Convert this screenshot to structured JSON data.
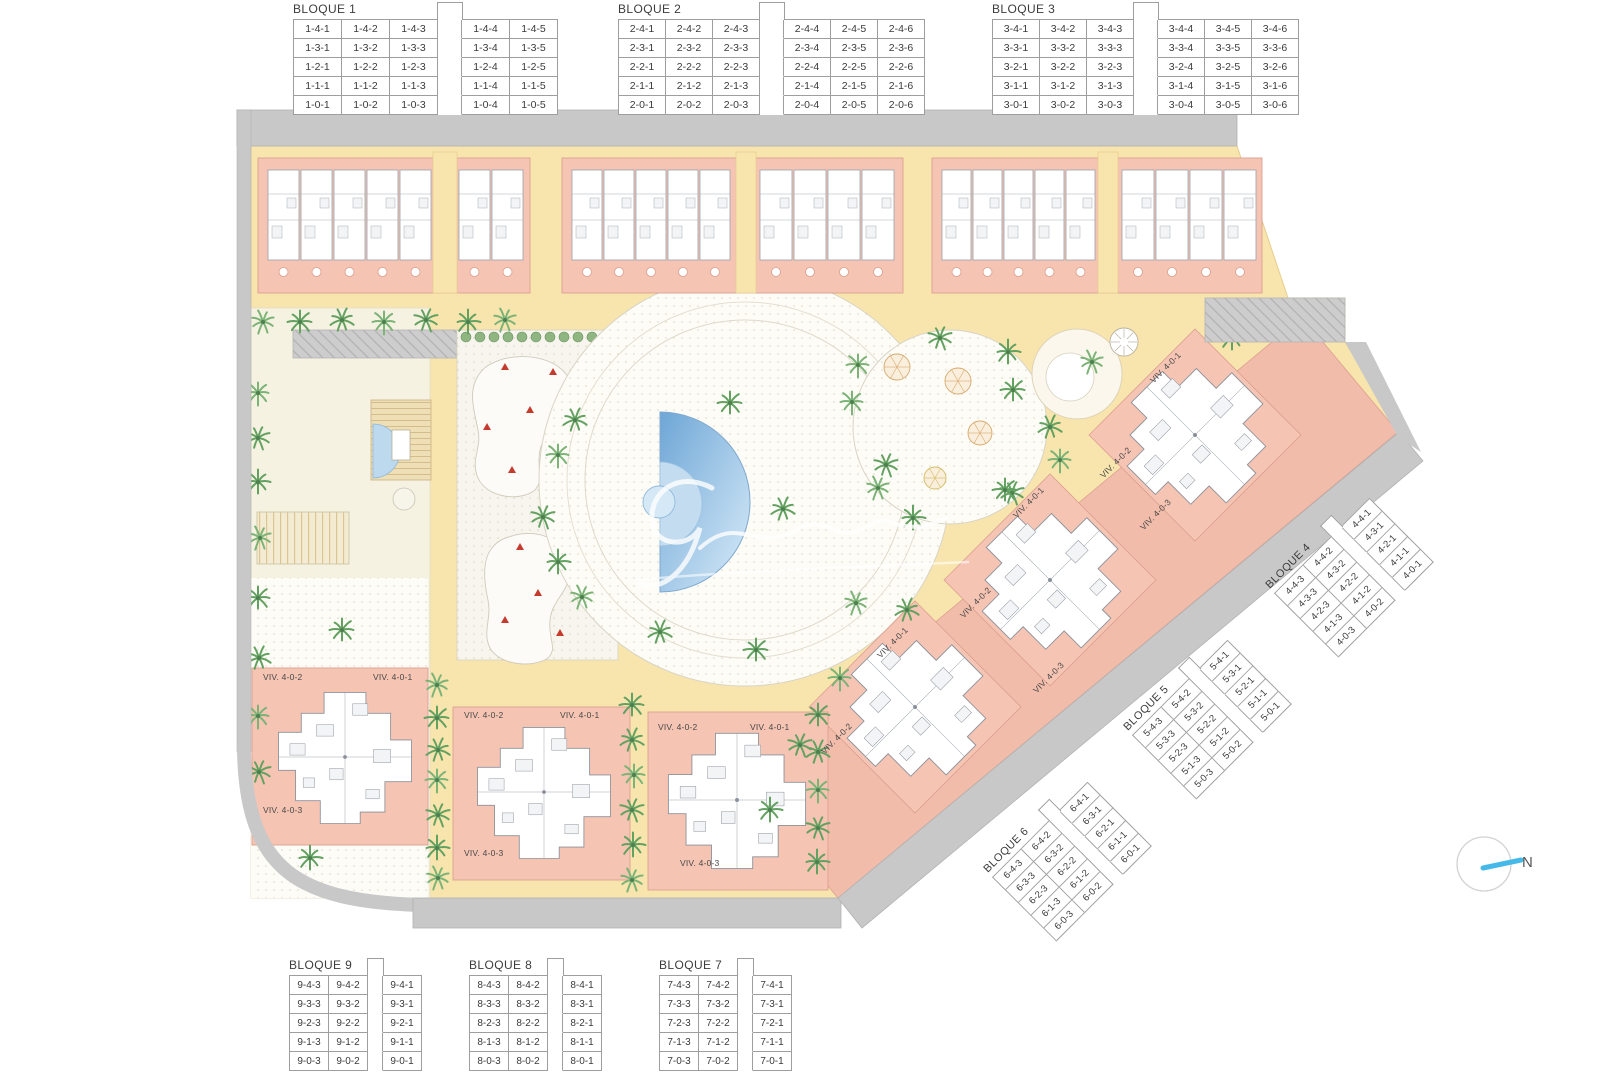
{
  "blocks_top": [
    {
      "title": "BLOQUE 1",
      "split_after": 3,
      "rows": [
        [
          "1-4-1",
          "1-4-2",
          "1-4-3",
          "1-4-4",
          "1-4-5"
        ],
        [
          "1-3-1",
          "1-3-2",
          "1-3-3",
          "1-3-4",
          "1-3-5"
        ],
        [
          "1-2-1",
          "1-2-2",
          "1-2-3",
          "1-2-4",
          "1-2-5"
        ],
        [
          "1-1-1",
          "1-1-2",
          "1-1-3",
          "1-1-4",
          "1-1-5"
        ],
        [
          "1-0-1",
          "1-0-2",
          "1-0-3",
          "1-0-4",
          "1-0-5"
        ]
      ]
    },
    {
      "title": "BLOQUE 2",
      "split_after": 3,
      "rows": [
        [
          "2-4-1",
          "2-4-2",
          "2-4-3",
          "2-4-4",
          "2-4-5",
          "2-4-6"
        ],
        [
          "2-3-1",
          "2-3-2",
          "2-3-3",
          "2-3-4",
          "2-3-5",
          "2-3-6"
        ],
        [
          "2-2-1",
          "2-2-2",
          "2-2-3",
          "2-2-4",
          "2-2-5",
          "2-2-6"
        ],
        [
          "2-1-1",
          "2-1-2",
          "2-1-3",
          "2-1-4",
          "2-1-5",
          "2-1-6"
        ],
        [
          "2-0-1",
          "2-0-2",
          "2-0-3",
          "2-0-4",
          "2-0-5",
          "2-0-6"
        ]
      ]
    },
    {
      "title": "BLOQUE 3",
      "split_after": 3,
      "rows": [
        [
          "3-4-1",
          "3-4-2",
          "3-4-3",
          "3-4-4",
          "3-4-5",
          "3-4-6"
        ],
        [
          "3-3-1",
          "3-3-2",
          "3-3-3",
          "3-3-4",
          "3-3-5",
          "3-3-6"
        ],
        [
          "3-2-1",
          "3-2-2",
          "3-2-3",
          "3-2-4",
          "3-2-5",
          "3-2-6"
        ],
        [
          "3-1-1",
          "3-1-2",
          "3-1-3",
          "3-1-4",
          "3-1-5",
          "3-1-6"
        ],
        [
          "3-0-1",
          "3-0-2",
          "3-0-3",
          "3-0-4",
          "3-0-5",
          "3-0-6"
        ]
      ]
    }
  ],
  "blocks_diagonal": [
    {
      "title": "BLOQUE 4",
      "split_after": 2,
      "rows": [
        [
          "4-4-3",
          "4-4-2",
          "4-4-1"
        ],
        [
          "4-3-3",
          "4-3-2",
          "4-3-1"
        ],
        [
          "4-2-3",
          "4-2-2",
          "4-2-1"
        ],
        [
          "4-1-3",
          "4-1-2",
          "4-1-1"
        ],
        [
          "4-0-3",
          "4-0-2",
          "4-0-1"
        ]
      ]
    },
    {
      "title": "BLOQUE 5",
      "split_after": 2,
      "rows": [
        [
          "5-4-3",
          "5-4-2",
          "5-4-1"
        ],
        [
          "5-3-3",
          "5-3-2",
          "5-3-1"
        ],
        [
          "5-2-3",
          "5-2-2",
          "5-2-1"
        ],
        [
          "5-1-3",
          "5-1-2",
          "5-1-1"
        ],
        [
          "5-0-3",
          "5-0-2",
          "5-0-1"
        ]
      ]
    },
    {
      "title": "BLOQUE 6",
      "split_after": 2,
      "rows": [
        [
          "6-4-3",
          "6-4-2",
          "6-4-1"
        ],
        [
          "6-3-3",
          "6-3-2",
          "6-3-1"
        ],
        [
          "6-2-3",
          "6-2-2",
          "6-2-1"
        ],
        [
          "6-1-3",
          "6-1-2",
          "6-1-1"
        ],
        [
          "6-0-3",
          "6-0-2",
          "6-0-1"
        ]
      ]
    }
  ],
  "blocks_bottom": [
    {
      "title": "BLOQUE 9",
      "split_after": 2,
      "rows": [
        [
          "9-4-3",
          "9-4-2",
          "9-4-1"
        ],
        [
          "9-3-3",
          "9-3-2",
          "9-3-1"
        ],
        [
          "9-2-3",
          "9-2-2",
          "9-2-1"
        ],
        [
          "9-1-3",
          "9-1-2",
          "9-1-1"
        ],
        [
          "9-0-3",
          "9-0-2",
          "9-0-1"
        ]
      ]
    },
    {
      "title": "BLOQUE 8",
      "split_after": 2,
      "rows": [
        [
          "8-4-3",
          "8-4-2",
          "8-4-1"
        ],
        [
          "8-3-3",
          "8-3-2",
          "8-3-1"
        ],
        [
          "8-2-3",
          "8-2-2",
          "8-2-1"
        ],
        [
          "8-1-3",
          "8-1-2",
          "8-1-1"
        ],
        [
          "8-0-3",
          "8-0-2",
          "8-0-1"
        ]
      ]
    },
    {
      "title": "BLOQUE 7",
      "split_after": 2,
      "rows": [
        [
          "7-4-3",
          "7-4-2",
          "7-4-1"
        ],
        [
          "7-3-3",
          "7-3-2",
          "7-3-1"
        ],
        [
          "7-2-3",
          "7-2-2",
          "7-2-1"
        ],
        [
          "7-1-3",
          "7-1-2",
          "7-1-1"
        ],
        [
          "7-0-3",
          "7-0-2",
          "7-0-1"
        ]
      ]
    }
  ],
  "unit_labels": {
    "v1": "VIV. 4-0-1",
    "v2": "VIV. 4-0-2",
    "v3": "VIV. 4-0-3"
  },
  "compass": {
    "label": "N"
  },
  "colors": {
    "building_pink": "#f5c4b3",
    "path_yellow": "#f8e5ad",
    "pool_blue": "#6ea6d6",
    "palm_green": "#63a161",
    "sidewalk_gray": "#c8c8c8",
    "play_red": "#c43b2e",
    "north_blue": "#45b9e7",
    "garden_cream": "#f6f2e2"
  }
}
